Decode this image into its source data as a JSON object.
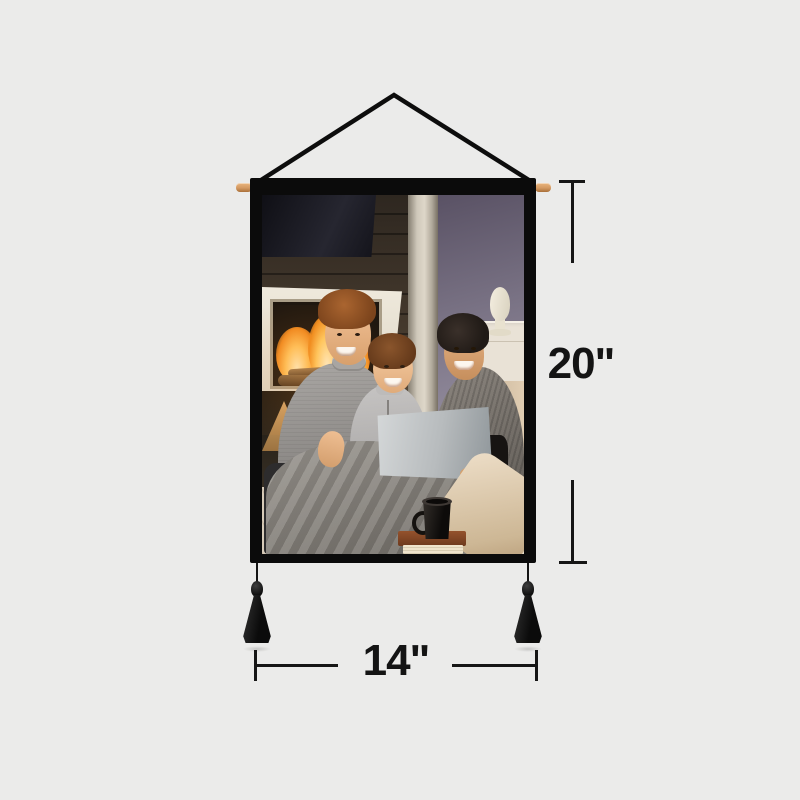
{
  "mockup": {
    "product": "hanging wall tapestry canvas print",
    "photo_description": "Father, young son and mother smiling on a couch with a silver laptop, gray blanket, mug on books and a lit fireplace behind them",
    "labels": {
      "height": "20\"",
      "width": "14\""
    },
    "colors": {
      "background": "#ebebea",
      "banner_fabric": "#0b0b0b",
      "dowel_wood": "#d49a63",
      "annotation_ink": "#161616"
    },
    "parts": {
      "hanging_cord": "black triangular hanging cord",
      "dowel": "wooden hanging rod",
      "tassels": "two black tassels"
    }
  }
}
